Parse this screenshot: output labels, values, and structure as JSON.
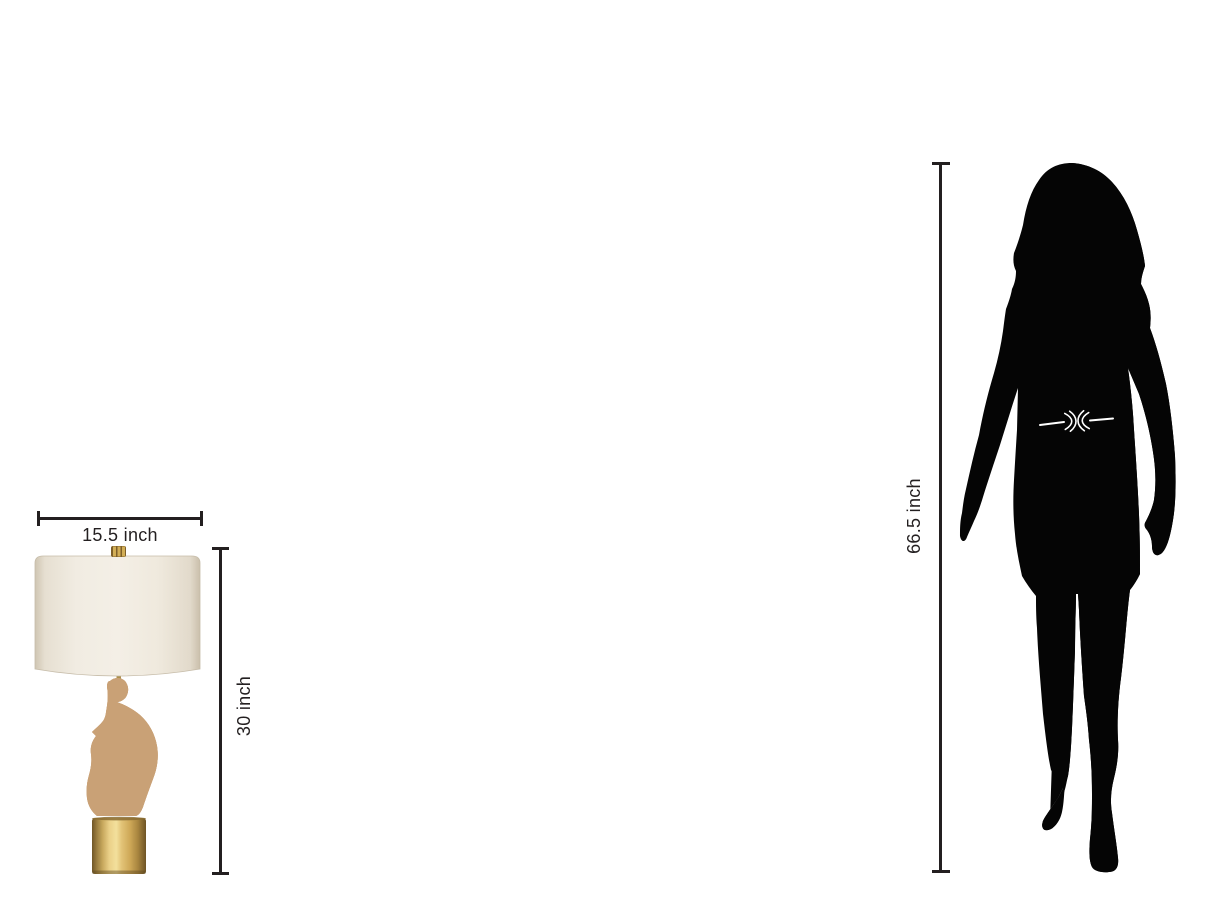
{
  "scene": {
    "kind": "product-size-comparison",
    "background": "#ffffff"
  },
  "lamp": {
    "width_label": "15.5 inch",
    "height_label": "30 inch",
    "colors": {
      "shade": "#f2ede3",
      "shade_edge": "#cfc5b2",
      "sculpture_tan": "#c9a176",
      "speckle": "#ffffff",
      "brass_base": "#e2c377",
      "finial_gold": "#d2ae56"
    }
  },
  "person": {
    "height_label": "66.5 inch",
    "silhouette_color": "#050505",
    "belt_color": "#ffffff"
  },
  "dimension_lines": {
    "line_color": "#231f20",
    "text_color": "#231f20"
  }
}
